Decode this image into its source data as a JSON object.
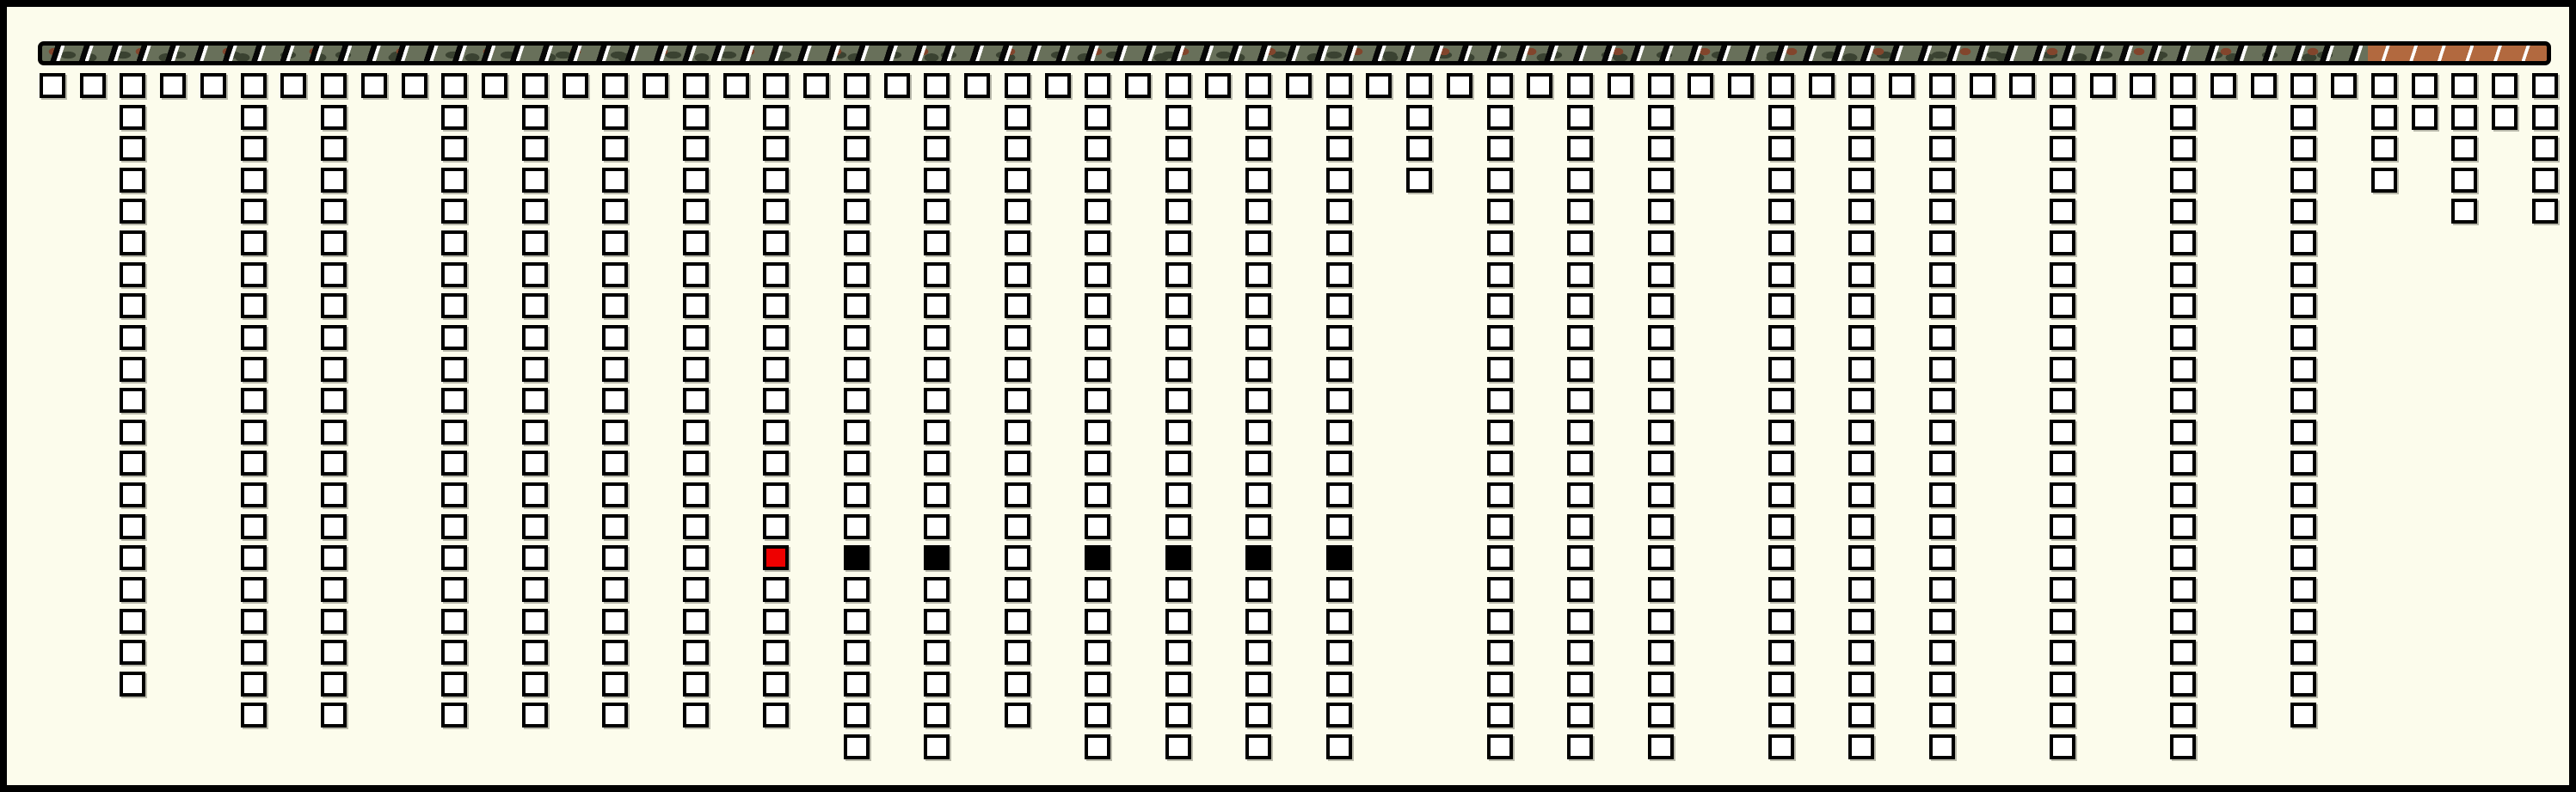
{
  "board": {
    "background_color": "#fcfcec",
    "border_color": "#000000",
    "slot_count": 63,
    "row_count": 22,
    "header_row_all_slots_filled": true,
    "cell_colors": {
      "fill": "#ffffff",
      "border": "#000000",
      "shadow": "#b9b9ab",
      "red": "#ee0000",
      "black": "#000000"
    },
    "columns": [
      {
        "slot": 2,
        "last_row": 19
      },
      {
        "slot": 5,
        "last_row": 20
      },
      {
        "slot": 7,
        "last_row": 20
      },
      {
        "slot": 10,
        "last_row": 20
      },
      {
        "slot": 12,
        "last_row": 20
      },
      {
        "slot": 14,
        "last_row": 20
      },
      {
        "slot": 16,
        "last_row": 20
      },
      {
        "slot": 18,
        "last_row": 20
      },
      {
        "slot": 20,
        "last_row": 21
      },
      {
        "slot": 22,
        "last_row": 21
      },
      {
        "slot": 24,
        "last_row": 20
      },
      {
        "slot": 26,
        "last_row": 21
      },
      {
        "slot": 28,
        "last_row": 21
      },
      {
        "slot": 30,
        "last_row": 21
      },
      {
        "slot": 32,
        "last_row": 21
      },
      {
        "slot": 34,
        "last_row": 3
      },
      {
        "slot": 36,
        "last_row": 21
      },
      {
        "slot": 38,
        "last_row": 21
      },
      {
        "slot": 40,
        "last_row": 21
      },
      {
        "slot": 43,
        "last_row": 21
      },
      {
        "slot": 45,
        "last_row": 21
      },
      {
        "slot": 47,
        "last_row": 21
      },
      {
        "slot": 50,
        "last_row": 21
      },
      {
        "slot": 53,
        "last_row": 21
      },
      {
        "slot": 56,
        "last_row": 20
      },
      {
        "slot": 58,
        "last_row": 3
      },
      {
        "slot": 59,
        "last_row": 1
      },
      {
        "slot": 60,
        "last_row": 4
      },
      {
        "slot": 61,
        "last_row": 1
      },
      {
        "slot": 62,
        "last_row": 4
      }
    ],
    "marks": [
      {
        "slot": 18,
        "row": 15,
        "type": "red"
      },
      {
        "slot": 20,
        "row": 15,
        "type": "black"
      },
      {
        "slot": 22,
        "row": 15,
        "type": "black"
      },
      {
        "slot": 26,
        "row": 15,
        "type": "black"
      },
      {
        "slot": 28,
        "row": 15,
        "type": "black"
      },
      {
        "slot": 30,
        "row": 15,
        "type": "black"
      },
      {
        "slot": 32,
        "row": 15,
        "type": "black"
      }
    ]
  },
  "progress_bar": {
    "tick_count": 87,
    "tick_color": "#ffffff",
    "camo_colors": {
      "base": "#68705a",
      "dark": "#3a4231",
      "brown": "#82452c"
    },
    "copper_section": {
      "color": "#b2693f",
      "start_ratio": 0.927
    }
  }
}
